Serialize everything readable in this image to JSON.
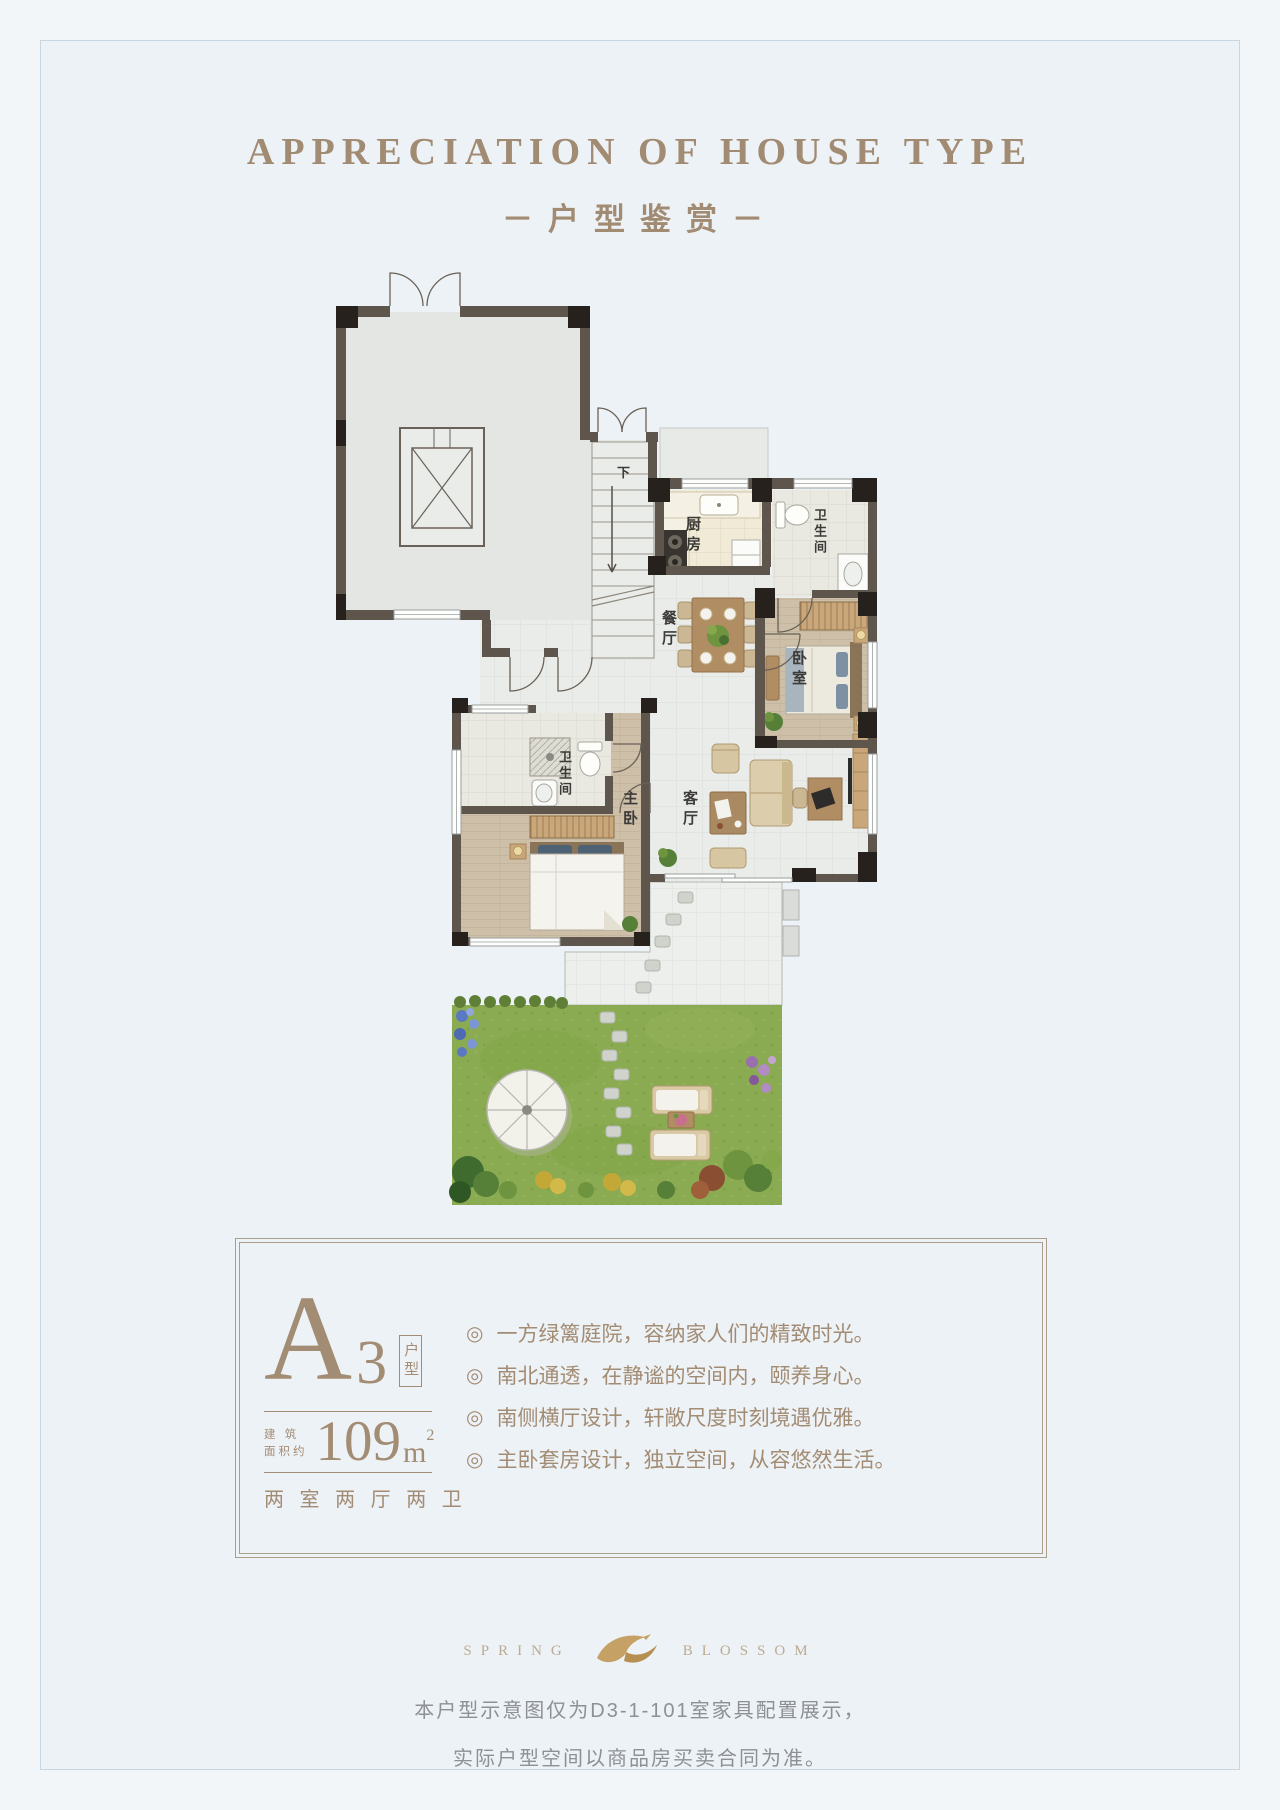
{
  "header": {
    "title_en": "APPRECIATION OF HOUSE TYPE",
    "title_cn": "－户型鉴赏－"
  },
  "floorplan": {
    "labels": {
      "down": "下",
      "kitchen": "厨房",
      "bath_top": "卫生间",
      "dining": "餐厅",
      "bedroom": "卧室",
      "bath_master": "卫生间",
      "master_bedroom": "主卧",
      "living": "客厅"
    }
  },
  "infobox": {
    "type_letter": "A",
    "type_number": "3",
    "type_tag": "户型",
    "area_label_line1": "建 筑",
    "area_label_line2": "面积约",
    "area_value": "109",
    "area_unit": "m",
    "area_exponent": "2",
    "rooms_summary": "两 室 两 厅 两 卫",
    "bullet_symbol": "◎",
    "bullets": [
      "一方绿篱庭院，容纳家人们的精致时光。",
      "南北通透，在静谧的空间内，颐养身心。",
      "南侧横厅设计，轩敞尺度时刻境遇优雅。",
      "主卧套房设计，独立空间，从容悠然生活。"
    ]
  },
  "footer": {
    "brand_left": "SPRING",
    "brand_right": "BLOSSOM",
    "disclaimer_line1": "本户型示意图仅为D3-1-101室家具配置展示，",
    "disclaimer_line2": "实际户型空间以商品房买卖合同为准。"
  },
  "colors": {
    "accent": "#a28b73",
    "background": "#edf2f6",
    "wall": "#5e564c",
    "grass": "#8aab51",
    "gold": "#c6a165"
  }
}
